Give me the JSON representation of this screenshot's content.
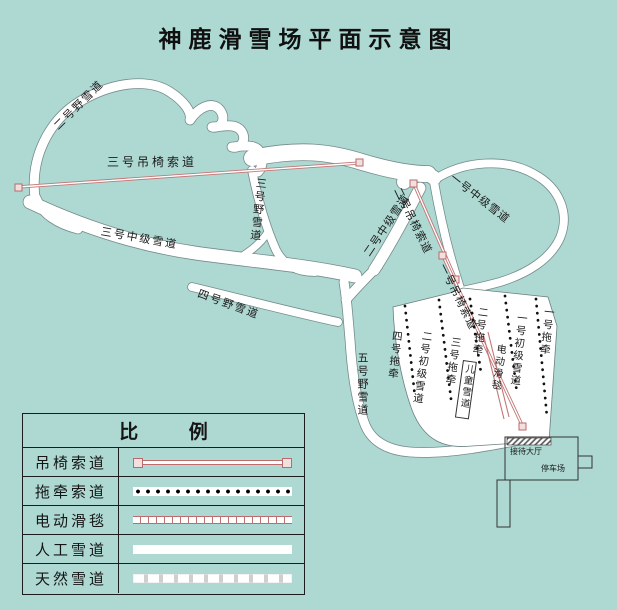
{
  "title": "神鹿滑雪场平面示意图",
  "colors": {
    "background": "#aed8d2",
    "trail_fill": "#ffffff",
    "trail_edge": "#6b7f7f",
    "chairlift_pink": "#c06c6c",
    "tow_dot_black": "#111111",
    "text": "#1a1a1a"
  },
  "map": {
    "trail_labels": [
      {
        "text": "二号野雪道"
      },
      {
        "text": "三号吊椅索道"
      },
      {
        "text": "三号野雪道"
      },
      {
        "text": "三号中级雪道"
      },
      {
        "text": "四号野雪道"
      },
      {
        "text": "五号野雪道"
      },
      {
        "text": "二号中级雪道"
      },
      {
        "text": "二号吊椅索道"
      },
      {
        "text": "一号中级雪道"
      },
      {
        "text": "一号吊椅索道"
      },
      {
        "text": "四号拖牵"
      },
      {
        "text": "二号初级雪道"
      },
      {
        "text": "三号拖牵"
      },
      {
        "text": "二号拖牵"
      },
      {
        "text": "儿童雪道"
      },
      {
        "text": "电动滑毯"
      },
      {
        "text": "一号初级雪道"
      },
      {
        "text": "一号拖牵"
      }
    ],
    "facility_labels": [
      {
        "text": "接待大厅"
      },
      {
        "text": "停车场"
      }
    ]
  },
  "legend": {
    "title": "比 例",
    "rows": [
      {
        "label": "吊椅索道",
        "symbol": "chairlift-line-symbol"
      },
      {
        "label": "拖牵索道",
        "symbol": "tow-line-symbol"
      },
      {
        "label": "电动滑毯",
        "symbol": "carpet-line-symbol"
      },
      {
        "label": "人工雪道",
        "symbol": "artificial-trail-symbol"
      },
      {
        "label": "天然雪道",
        "symbol": "natural-trail-symbol"
      }
    ]
  }
}
